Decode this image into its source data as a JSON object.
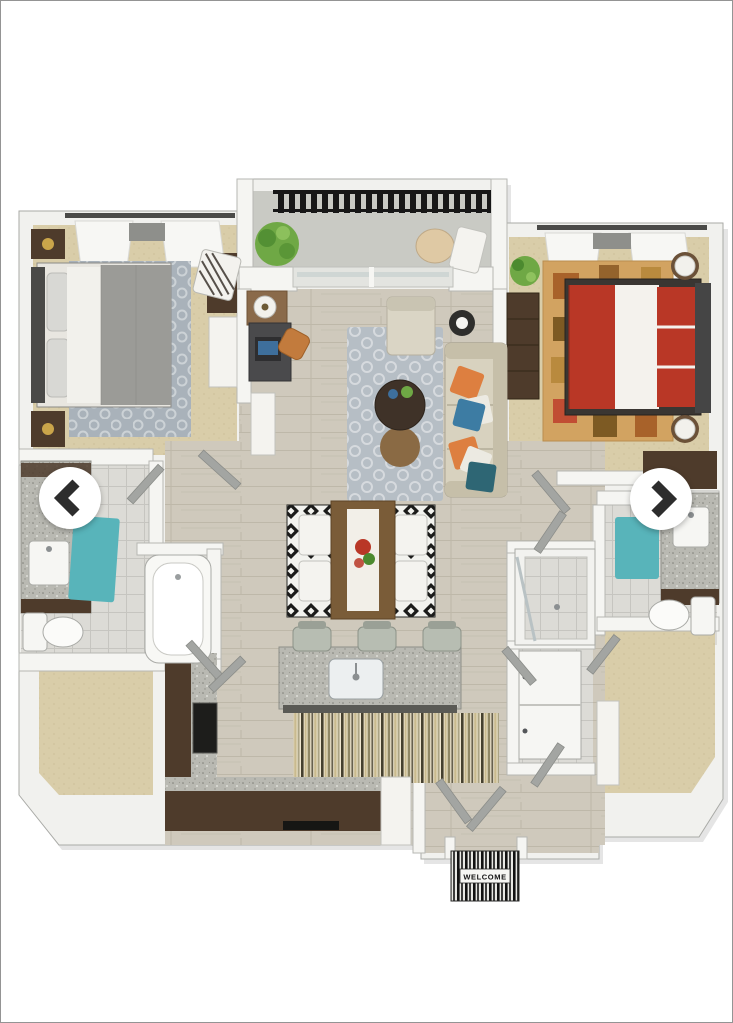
{
  "viewer": {
    "type": "floor-plan-gallery",
    "welcome_mat_text": "WELCOME",
    "nav": {
      "prev_icon": "chevron-left",
      "next_icon": "chevron-right"
    }
  },
  "floorplan": {
    "style": "3d-top-down-render",
    "rooms": [
      {
        "id": "balcony",
        "furniture": [
          "potted-plant",
          "round-table",
          "patio-chair",
          "railing"
        ]
      },
      {
        "id": "bedroom-left",
        "furniture": [
          "queen-bed-gray",
          "nightstand",
          "nightstand",
          "area-rug",
          "accent-chair",
          "console",
          "window-curtains",
          "wall-tv"
        ]
      },
      {
        "id": "bedroom-right",
        "furniture": [
          "queen-bed-red",
          "dresser",
          "potted-plant",
          "area-rug",
          "lamp",
          "lamp",
          "window-curtains",
          "wardrobe"
        ]
      },
      {
        "id": "living-room",
        "furniture": [
          "sofa",
          "throw-pillows",
          "coffee-table",
          "ottoman",
          "armchair",
          "floor-lamp",
          "area-rug",
          "desk",
          "laptop",
          "desk-chair",
          "table-lamp",
          "console",
          "sliding-glass-door"
        ]
      },
      {
        "id": "dining-area",
        "furniture": [
          "dining-table",
          "table-runner",
          "centerpiece",
          "chair",
          "chair",
          "chair",
          "chair",
          "geometric-rug"
        ]
      },
      {
        "id": "kitchen",
        "furniture": [
          "island",
          "sink",
          "bar-stool",
          "bar-stool",
          "bar-stool",
          "counter-l-shape",
          "stove",
          "dishwasher",
          "fridge",
          "runner-rug"
        ]
      },
      {
        "id": "bathroom-left",
        "furniture": [
          "vanity-sink",
          "teal-rug",
          "toilet",
          "bathtub"
        ]
      },
      {
        "id": "bathroom-right",
        "furniture": [
          "vanity-sink",
          "teal-rug",
          "toilet",
          "walk-in-shower",
          "washer-dryer"
        ]
      },
      {
        "id": "walk-in-closet-left",
        "furniture": []
      },
      {
        "id": "walk-in-closet-right",
        "furniture": [
          "shelf"
        ]
      },
      {
        "id": "entry",
        "furniture": [
          "welcome-mat",
          "double-doors"
        ]
      }
    ],
    "palette": {
      "wall": "#f5f5f2",
      "wallStroke": "#b6b7b3",
      "slab": "#f1f1ee",
      "slabEdge": "#a9aaa6",
      "woodFloor": "#cfc9bc",
      "woodLine": "#bdb6a8",
      "carpet": "#d9cda9",
      "carpetDot": "#c4b78f",
      "tile": "#dcdbd6",
      "tileLine": "#c6c5c0",
      "balconyFloor": "#c9cac4",
      "granite": "#b9b9b2",
      "darkWood": "#4e3b2b",
      "midWood": "#7a5c38",
      "teal": "#58b4ba",
      "red": "#b93726",
      "orange": "#dd7f40",
      "blue": "#3d7ca3",
      "darkTeal": "#2e6674",
      "sofa": "#d8d2bf",
      "sofaTrim": "#c6bfa9",
      "green": "#6fa845",
      "greenDark": "#4c8a2f",
      "railing": "#171717",
      "grayDuvet": "#9b9b97",
      "whiteFurn": "#f4f3ef",
      "rugBWDark": "#1b1b1a",
      "rugBWLight": "#f2f2ee",
      "rugLivingBase": "#b6bec5",
      "rugLivingSwirl": "#d6dade",
      "rugBedLeftBase": "#a9b2ba",
      "rugBedLeftSwirl": "#ccd2d6",
      "rugBedRightBase": "#d2a361",
      "stripeA": "#45402f",
      "stripeB": "#c9ba8e",
      "stripeC": "#efe6cf",
      "stripeD": "#8f8765",
      "arrowBg": "#ffffff",
      "arrowGlyph": "#2d2d2d",
      "matDark": "#111111",
      "matLight": "#e8e8e4",
      "doorPanel": "#a3a5a2",
      "frame": "#8b8d89"
    }
  }
}
